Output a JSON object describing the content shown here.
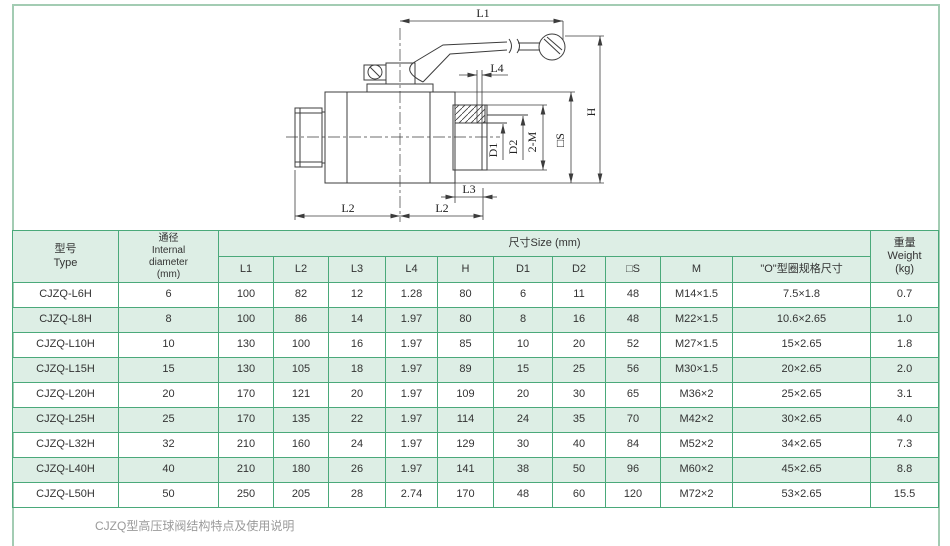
{
  "page": {
    "frame_color": "#a3ccb3",
    "table_border_color": "#4aa97a",
    "table_tint_color": "#ddeee5",
    "drawing_line_color": "#3c3c3c"
  },
  "drawing": {
    "description": "ball-valve-technical-drawing",
    "labels": {
      "l1": "L1",
      "l2_left": "L2",
      "l2_right": "L2",
      "l3": "L3",
      "l4": "L4",
      "h": "H",
      "square_s": "□S",
      "two_m": "2-M",
      "d1": "D1",
      "d2": "D2"
    }
  },
  "table": {
    "headers": {
      "type": "型号\nType",
      "diameter": "通径\nInternal\ndiameter\n(mm)",
      "size_group": "尺寸Size (mm)",
      "size_cols": [
        "L1",
        "L2",
        "L3",
        "L4",
        "H",
        "D1",
        "D2",
        "□S",
        "M",
        "\"O\"型圈规格尺寸"
      ],
      "weight": "重量\nWeight\n(kg)"
    },
    "rows": [
      [
        "CJZQ-L6H",
        "6",
        "100",
        "82",
        "12",
        "1.28",
        "80",
        "6",
        "11",
        "48",
        "M14×1.5",
        "7.5×1.8",
        "0.7"
      ],
      [
        "CJZQ-L8H",
        "8",
        "100",
        "86",
        "14",
        "1.97",
        "80",
        "8",
        "16",
        "48",
        "M22×1.5",
        "10.6×2.65",
        "1.0"
      ],
      [
        "CJZQ-L10H",
        "10",
        "130",
        "100",
        "16",
        "1.97",
        "85",
        "10",
        "20",
        "52",
        "M27×1.5",
        "15×2.65",
        "1.8"
      ],
      [
        "CJZQ-L15H",
        "15",
        "130",
        "105",
        "18",
        "1.97",
        "89",
        "15",
        "25",
        "56",
        "M30×1.5",
        "20×2.65",
        "2.0"
      ],
      [
        "CJZQ-L20H",
        "20",
        "170",
        "121",
        "20",
        "1.97",
        "109",
        "20",
        "30",
        "65",
        "M36×2",
        "25×2.65",
        "3.1"
      ],
      [
        "CJZQ-L25H",
        "25",
        "170",
        "135",
        "22",
        "1.97",
        "114",
        "24",
        "35",
        "70",
        "M42×2",
        "30×2.65",
        "4.0"
      ],
      [
        "CJZQ-L32H",
        "32",
        "210",
        "160",
        "24",
        "1.97",
        "129",
        "30",
        "40",
        "84",
        "M52×2",
        "34×2.65",
        "7.3"
      ],
      [
        "CJZQ-L40H",
        "40",
        "210",
        "180",
        "26",
        "1.97",
        "141",
        "38",
        "50",
        "96",
        "M60×2",
        "45×2.65",
        "8.8"
      ],
      [
        "CJZQ-L50H",
        "50",
        "250",
        "205",
        "28",
        "2.74",
        "170",
        "48",
        "60",
        "120",
        "M72×2",
        "53×2.65",
        "15.5"
      ]
    ]
  },
  "footer": {
    "note": "CJZQ型高压球阀结构特点及使用说明"
  }
}
